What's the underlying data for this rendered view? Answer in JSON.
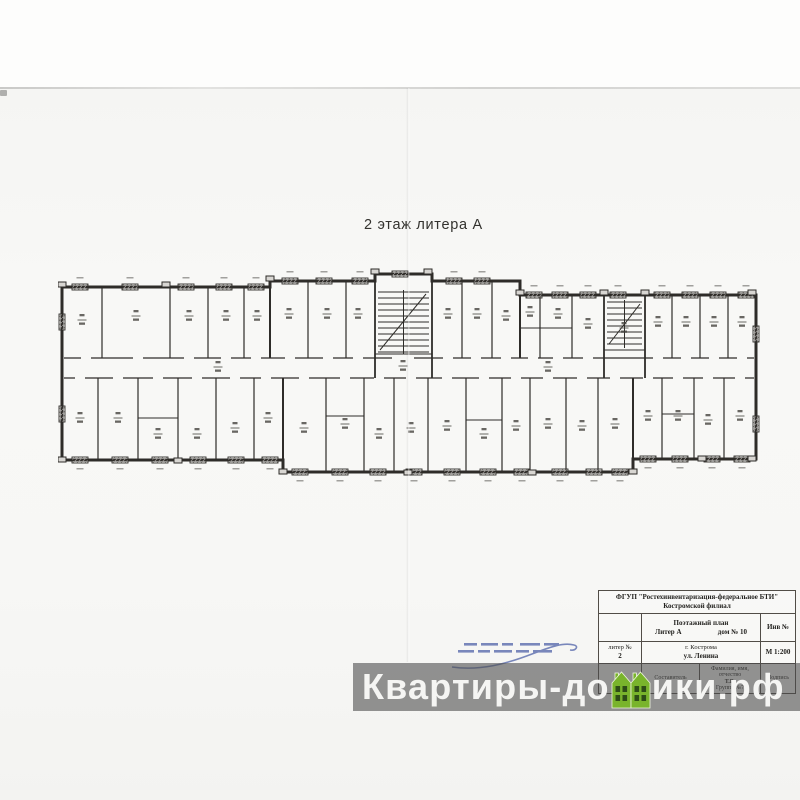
{
  "page": {
    "plan_title": "2 этаж литера А",
    "paper_color": "#f7f7f5",
    "plan_line_color": "#2e2c29"
  },
  "title_block": {
    "org_line1": "ФГУП \"Ростехинвентаризация-федеральное БТИ\"",
    "org_line2": "Костромской филиал",
    "doc_type": "Поэтажный план",
    "liter": "Литер А",
    "house": "дом № 10",
    "inv_label": "Инв №",
    "liter_no_label": "литер №",
    "liter_no_value": "2",
    "city": "г. Кострома",
    "street": "ул. Ленина",
    "scale": "М 1:200",
    "composer_label": "Составитель",
    "fio_label_line1": "Фамилия, имя,",
    "fio_label_line2": "отчество",
    "fio_value": "Т.В.",
    "group_value": "Группа №7",
    "sign_label": "Подпись"
  },
  "watermark": {
    "text_left": "Квартиры-до",
    "text_right": "ики.рф",
    "full_text": "Квартиры-домики.рф",
    "band_color": "rgba(77,77,77,0.60)",
    "text_color": "#f5f5f3",
    "house_green": "#79b42c",
    "house_window_green": "#2e4d17"
  },
  "stamp": {
    "color": "#5b6cad"
  }
}
